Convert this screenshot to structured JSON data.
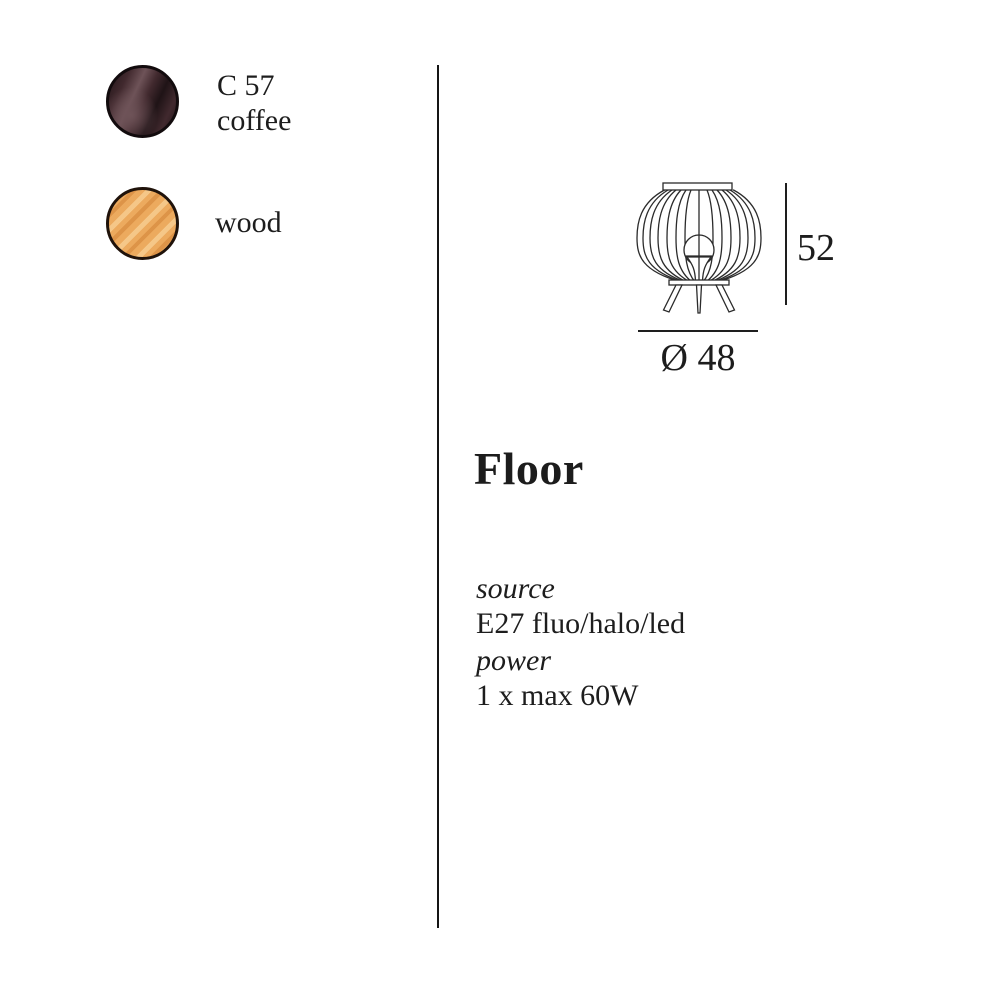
{
  "page": {
    "background": "#ffffff",
    "text_color": "#1d1d1d"
  },
  "divider": {
    "color": "#151515"
  },
  "swatches": [
    {
      "code": "C 57",
      "name": "coffee",
      "base_color": "#41292e",
      "highlight_color": "#6e5358",
      "shadow_color": "#1f1316",
      "border_color": "#120b0d"
    },
    {
      "code": "",
      "name": "wood",
      "base_color": "#ecaa5e",
      "highlight_color": "#f5c788",
      "shadow_color": "#dd9448",
      "border_color": "#1f120a"
    }
  ],
  "diagram": {
    "height_value": "52",
    "diameter_value": "Ø 48",
    "stroke_color": "#2b2b2b",
    "dimension_line_color": "#1e1e1e"
  },
  "product": {
    "title": "Floor",
    "specs": [
      {
        "label": "source",
        "value": "E27 fluo/halo/led"
      },
      {
        "label": "power",
        "value": "1 x max 60W"
      }
    ]
  }
}
